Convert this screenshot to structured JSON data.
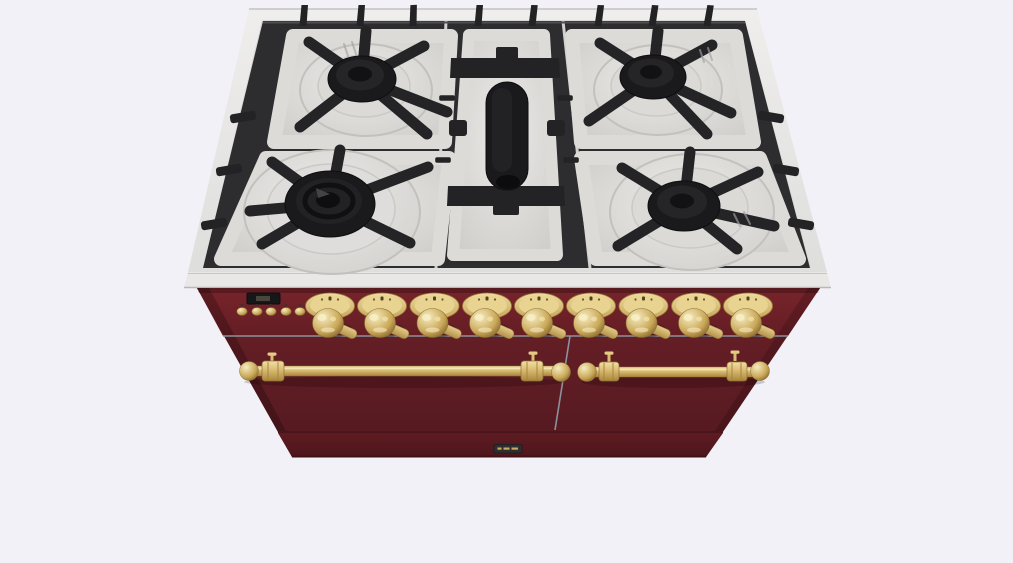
{
  "scene": {
    "name": "range-cooker-product-render",
    "description": "3/4 top-front view 3D render of a freestanding double-oven gas range, burgundy finish with brass trim",
    "view_angle": "top-front"
  },
  "colors": {
    "background": "#f2f1f7",
    "steel_frame": "#e9e8e6",
    "steel_deck": "#d9d8d6",
    "grate_black": "#2d2d2f",
    "burner_black": "#1a1a1c",
    "body_burgundy": "#6b2026",
    "body_burgundy_dark": "#571a20",
    "brass": "#d9ba70",
    "brass_light": "#eedfa7",
    "brass_dark": "#9c7c36",
    "divider_gray": "#8b929c",
    "display_black": "#17171a",
    "badge_plate": "#2e2e30"
  },
  "cooktop": {
    "name": "gas-cooktop",
    "burner_count": 5,
    "grate_sections": 3,
    "burners": [
      {
        "id": "back-left",
        "type": "standard-burner"
      },
      {
        "id": "front-left",
        "type": "dual-ring-wok-burner"
      },
      {
        "id": "center",
        "type": "oval-griddle-burner"
      },
      {
        "id": "back-right",
        "type": "standard-burner"
      },
      {
        "id": "front-right",
        "type": "standard-burner"
      }
    ]
  },
  "control_panel": {
    "display": {
      "name": "clock-display",
      "text": ""
    },
    "button_count": 5,
    "buttons": [
      {
        "id": "panel-button-1"
      },
      {
        "id": "panel-button-2"
      },
      {
        "id": "panel-button-3"
      },
      {
        "id": "panel-button-4"
      },
      {
        "id": "panel-button-5"
      }
    ],
    "knob_count": 9,
    "knobs": [
      {
        "id": "burner-knob-1"
      },
      {
        "id": "burner-knob-2"
      },
      {
        "id": "burner-knob-3"
      },
      {
        "id": "burner-knob-4"
      },
      {
        "id": "burner-knob-5"
      },
      {
        "id": "burner-knob-6"
      },
      {
        "id": "burner-knob-7"
      },
      {
        "id": "burner-knob-8"
      },
      {
        "id": "burner-knob-9"
      }
    ]
  },
  "doors": {
    "left": {
      "name": "left-oven-door",
      "handle": "brass-rail-handle"
    },
    "right": {
      "name": "right-oven-door",
      "handle": "brass-rail-handle"
    }
  },
  "badge": {
    "name": "brand-nameplate",
    "text": ""
  }
}
